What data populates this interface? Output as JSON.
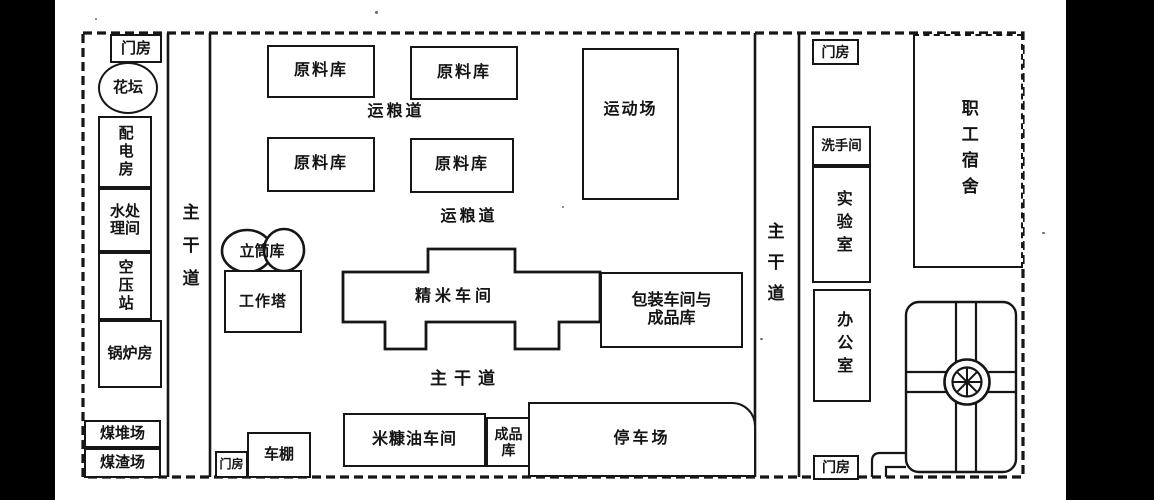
{
  "colors": {
    "ink": "#161616",
    "paper": "#ffffff",
    "frame_bar": "#000000"
  },
  "site_plan": {
    "west_column": {
      "gatehouse": "门房",
      "flower_bed": "花坛",
      "power_distribution_room": "配电房",
      "water_treatment_room": "水处理间",
      "air_compressor_station": "空压站",
      "boiler_room": "锅炉房",
      "coal_pile_yard": "煤堆场",
      "coal_cinder_yard": "煤渣场"
    },
    "roads": {
      "main_road_west": "主干道",
      "main_road_east": "主干道",
      "main_road_center": "主干道",
      "grain_road_upper": "运粮道",
      "grain_road_lower": "运粮道"
    },
    "central_area": {
      "raw_material_warehouse": "原料库",
      "sports_field": "运动场",
      "silo": "立筒库",
      "work_tower": "工作塔",
      "rice_milling_workshop": "精米车间",
      "packaging_and_finished_goods": "包装车间与成品库",
      "rice_bran_oil_workshop": "米糠油车间",
      "finished_goods_warehouse": "成品库",
      "parking_lot": "停车场",
      "bike_shed": "车棚",
      "gatehouse_south": "门房"
    },
    "east_column": {
      "gatehouse_north": "门房",
      "washroom": "洗手间",
      "laboratory": "实验室",
      "office": "办公室",
      "gatehouse_south": "门房",
      "staff_dormitory": "职工宿舍"
    }
  }
}
